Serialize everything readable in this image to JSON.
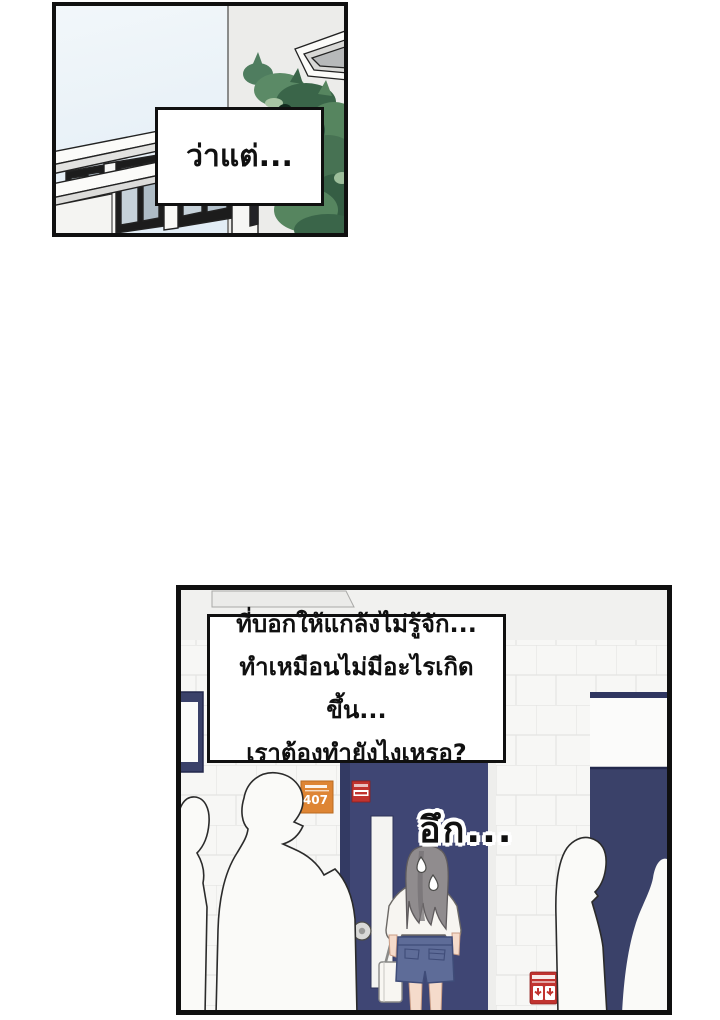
{
  "page": {
    "type": "webtoon-comic-page",
    "background_color": "#ffffff"
  },
  "panels": {
    "top": {
      "speech": "ว่าแต่...",
      "scene": "exterior school building with foliage and window"
    },
    "bottom": {
      "speech_lines": {
        "0": "ที่บอกให้แกล้งไม่รู้จัก...",
        "1": "ทำเหมือนไม่มีอะไรเกิดขึ้น...",
        "2": "เราต้องทำยังไงเหรอ?"
      },
      "sfx": "อึก...",
      "door_sign_number": "407",
      "scene": "hallway with navy door, girl facing door, crowd silhouettes"
    }
  },
  "colors": {
    "panel_border": "#101010",
    "sky": "#eaf2f8",
    "exterior_wall": "#ececea",
    "foliage_dark": "#2e5743",
    "foliage_mid": "#56855f",
    "foliage_light": "#9dbe9b",
    "tile_wall": "#f7f7f5",
    "tile_grout": "#e4e4e2",
    "navy_wall": "#3a4169",
    "door_frame": "#333a63",
    "door_face": "#3f4674",
    "orange_sign": "#de8534",
    "red_sign": "#c1332f",
    "hair": "#908c8e",
    "skin": "#f5dbcb",
    "denim_shorts": "#5e6c98",
    "silhouette_fill": "#fafaf8"
  }
}
